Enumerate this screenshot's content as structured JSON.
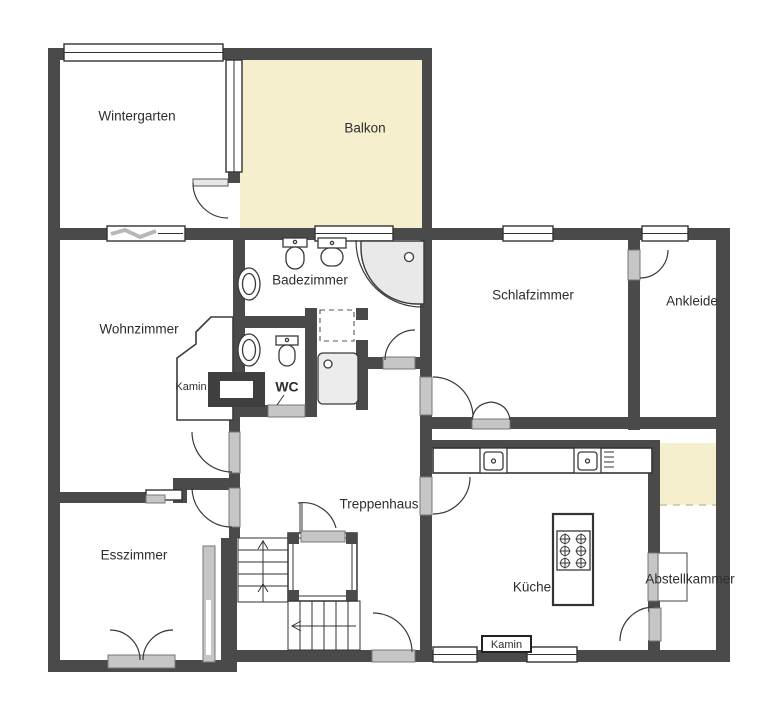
{
  "rooms": {
    "wintergarten": {
      "label": "Wintergarten"
    },
    "balkon": {
      "label": "Balkon"
    },
    "wohnzimmer": {
      "label": "Wohnzimmer"
    },
    "badezimmer": {
      "label": "Badezimmer"
    },
    "schlafzimmer": {
      "label": "Schlafzimmer"
    },
    "ankleide": {
      "label": "Ankleide"
    },
    "wc": {
      "label": "WC"
    },
    "treppenhaus": {
      "label": "Treppenhaus"
    },
    "esszimmer": {
      "label": "Esszimmer"
    },
    "kueche": {
      "label": "Küche"
    },
    "abstellkammer": {
      "label": "Abstellkammer"
    }
  },
  "features": {
    "kamin_wohnzimmer": {
      "label": "Kamin"
    },
    "kamin_kueche": {
      "label": "Kamin"
    }
  },
  "colors": {
    "wall": "#4a4a4a",
    "balcony_fill": "#f5efce",
    "storage_highlight_fill": "#f5efce",
    "door_fill": "#c6c6c6",
    "label_text": "#2e2e2e",
    "background": "#ffffff"
  },
  "icons": {
    "window": "window-icon",
    "folding_window": "folding-window-icon",
    "swing_door": "door-swing-icon",
    "sliding_door": "sliding-door-icon",
    "double_door": "double-door-icon",
    "toilet": "toilet-icon",
    "sink": "sink-icon",
    "corner_shower": "corner-shower-icon",
    "shower_tray": "shower-tray-icon",
    "fireplace": "fireplace-icon",
    "stairs": "stairs-up-icon",
    "elevator": "elevator-icon",
    "kitchen_sink": "kitchen-sink-icon",
    "stove": "stove-icon",
    "kitchen_island": "kitchen-island",
    "cabinet": "cabinet-icon"
  }
}
